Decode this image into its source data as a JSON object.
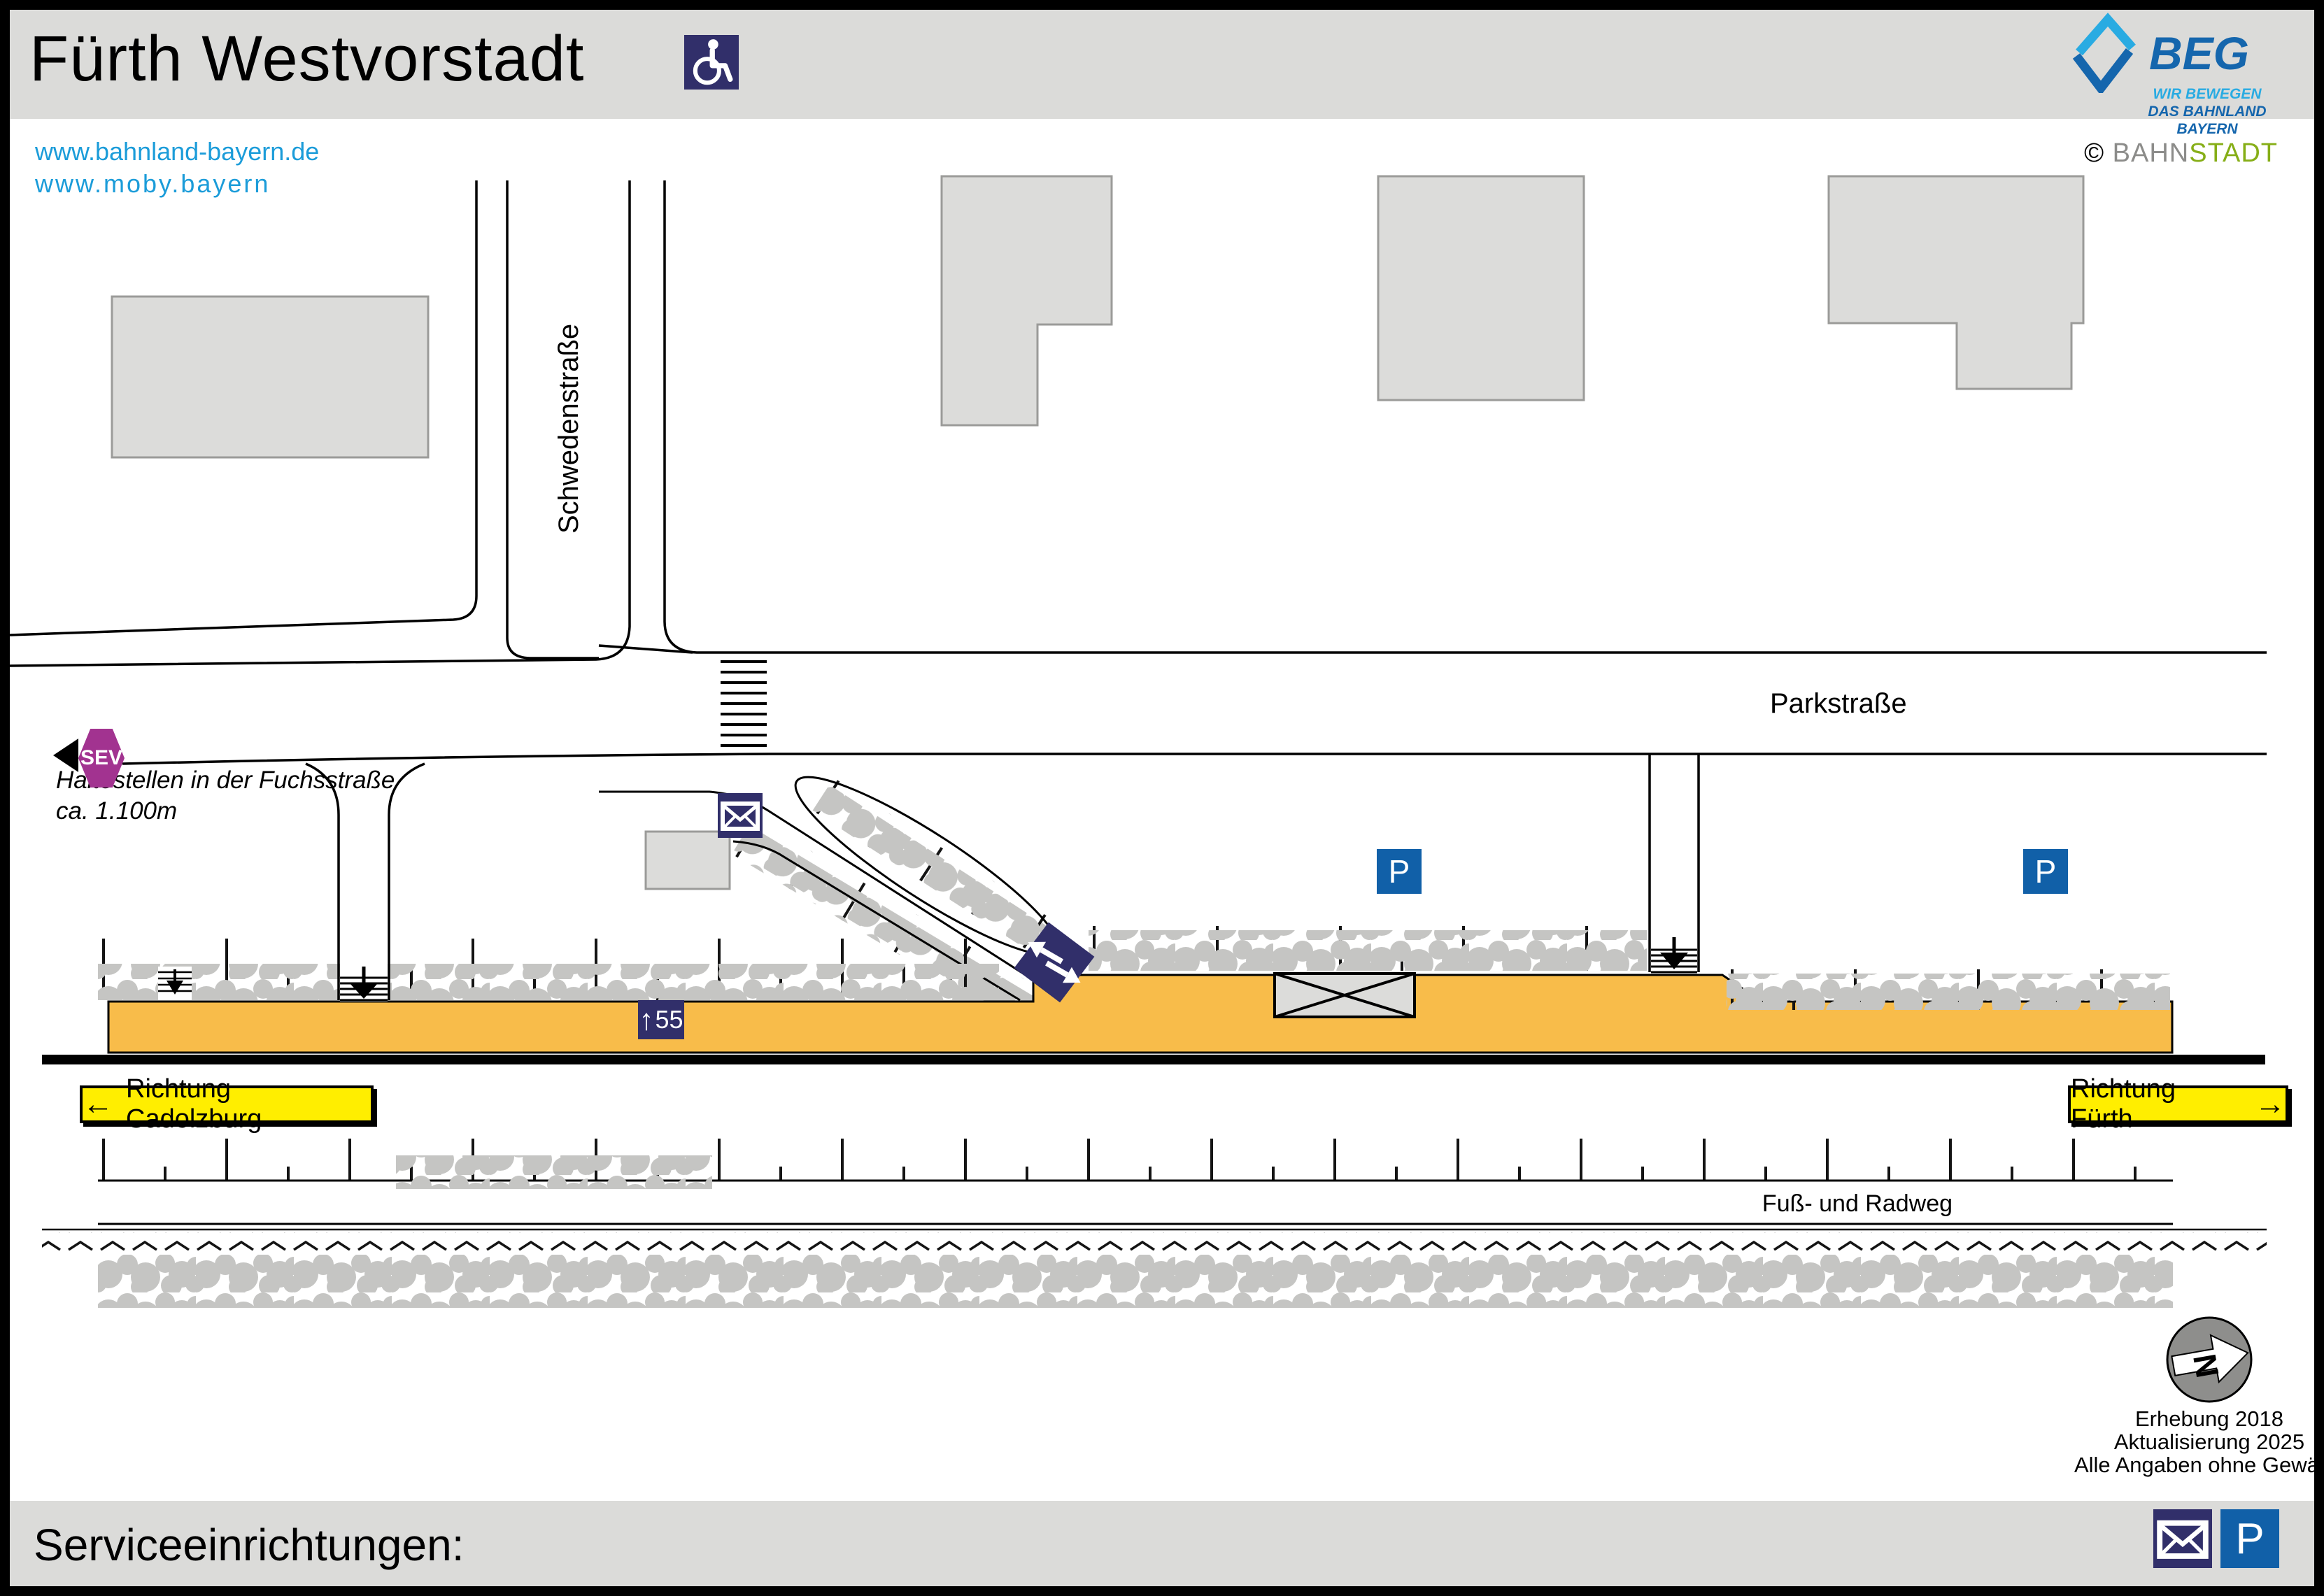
{
  "header": {
    "title": "Fürth Westvorstadt",
    "urls": [
      "www.bahnland-bayern.de",
      "www.moby.bayern"
    ],
    "beg": {
      "wordmark": "BEG",
      "tagline1": "WIR BEWEGEN",
      "tagline2": "DAS BAHNLAND BAYERN"
    },
    "credit": {
      "symbol": "©",
      "gray_part": "BAHN",
      "green_part": "STADT"
    }
  },
  "map": {
    "streets": {
      "vertical": "Schwedenstraße",
      "horizontal": "Parkstraße"
    },
    "sev": {
      "label": "SEV",
      "note_line1": "Haltestellen in der Fuchsstraße",
      "note_line2": "ca. 1.100m"
    },
    "platform": {
      "height_sign_arrow": "↑",
      "height_sign_value": "55"
    },
    "directions": {
      "left_arrow": "←",
      "left_label": "Richtung Cadolzburg",
      "right_label": "Richtung Fürth",
      "right_arrow": "→"
    },
    "labels": {
      "footpath": "Fuß- und Radweg"
    },
    "signs": {
      "parking": "P"
    },
    "compass": {
      "letter": "N"
    },
    "notes": [
      "Erhebung 2018",
      "Aktualisierung 2025",
      "Alle Angaben ohne Gewähr!"
    ]
  },
  "footer": {
    "label": "Serviceeinrichtungen:"
  },
  "icons": {
    "wheelchair": "wheelchair-icon",
    "mailbox": "envelope-icon",
    "parking": "parking-icon",
    "sev_direction": "left-triangle-icon",
    "compass": "north-arrow-icon"
  },
  "colors": {
    "platform_orange": "#f8bc4a",
    "sign_navy": "#312f6a",
    "parking_blue": "#1160a8",
    "sev_purple": "#a23390",
    "direction_yellow": "#ffee00",
    "beg_light_blue": "#29abe2",
    "beg_dark_blue": "#1566ad",
    "bahnstadt_green": "#86ae17",
    "link_blue": "#1b9cd9",
    "band_gray": "#dbdbd9",
    "building_gray": "#dcdcda",
    "hedge_gray": "#c5c5c3"
  }
}
